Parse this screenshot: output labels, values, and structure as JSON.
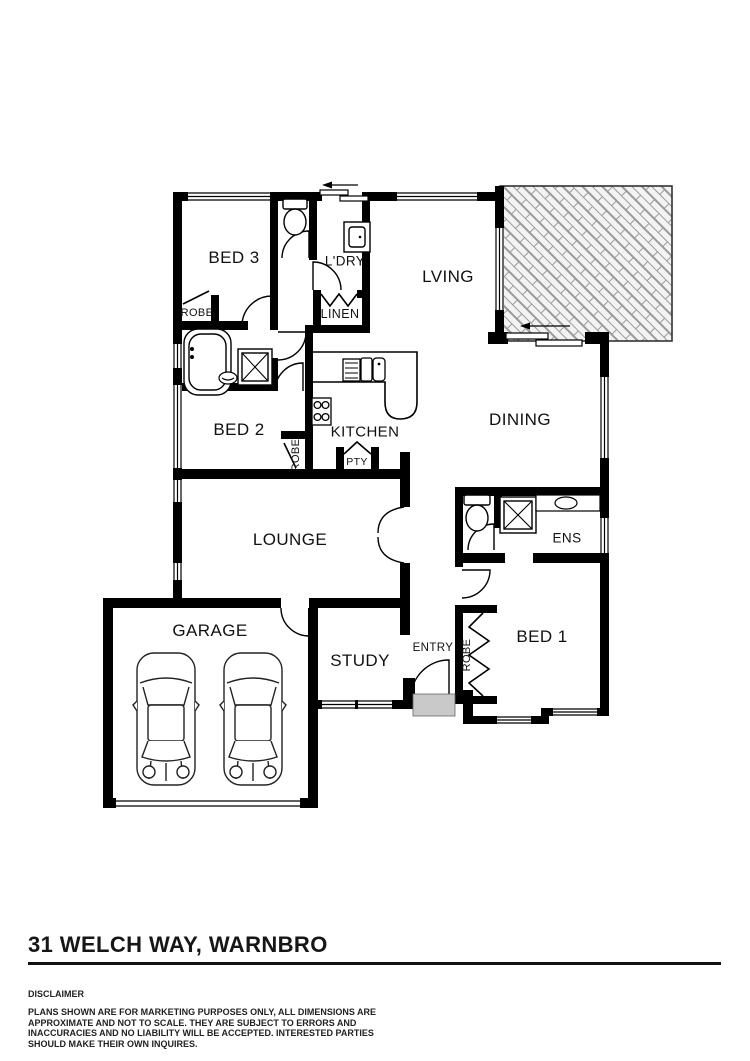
{
  "plan": {
    "rooms": {
      "bed3": "BED 3",
      "bed3_robe": "ROBE",
      "ldry": "L'DRY",
      "linen": "LINEN",
      "lving": "LVING",
      "bed2": "BED 2",
      "bed2_robe": "ROBE",
      "kitchen": "KITCHEN",
      "pty": "PTY",
      "dining": "DINING",
      "lounge": "LOUNGE",
      "ens": "ENS",
      "garage": "GARAGE",
      "study": "STUDY",
      "entry": "ENTRY",
      "bed1_robe": "ROBE",
      "bed1": "BED 1"
    },
    "fixtures": [
      "toilet",
      "bathtub",
      "shower",
      "kitchen-sink",
      "cooktop",
      "laundry-trough",
      "vanity-basin",
      "car",
      "car",
      "sliding-door-arrow",
      "brick-paved-patio",
      "entry-porch-step"
    ],
    "colors": {
      "wall": "#000000",
      "porch": "#c9c9c9",
      "brick_fill": "#f3f3f3",
      "brick_line": "#9a9a9a"
    }
  },
  "footer": {
    "address": "31 WELCH WAY, WARNBRO",
    "disclaimer_heading": "DISCLAIMER",
    "disclaimer_text": "PLANS SHOWN ARE FOR MARKETING PURPOSES ONLY, ALL DIMENSIONS ARE APPROXIMATE AND NOT TO SCALE. THEY ARE SUBJECT TO ERRORS AND INACCURACIES AND NO LIABILITY WILL BE ACCEPTED. INTERESTED PARTIES SHOULD MAKE THEIR OWN INQUIRES."
  }
}
